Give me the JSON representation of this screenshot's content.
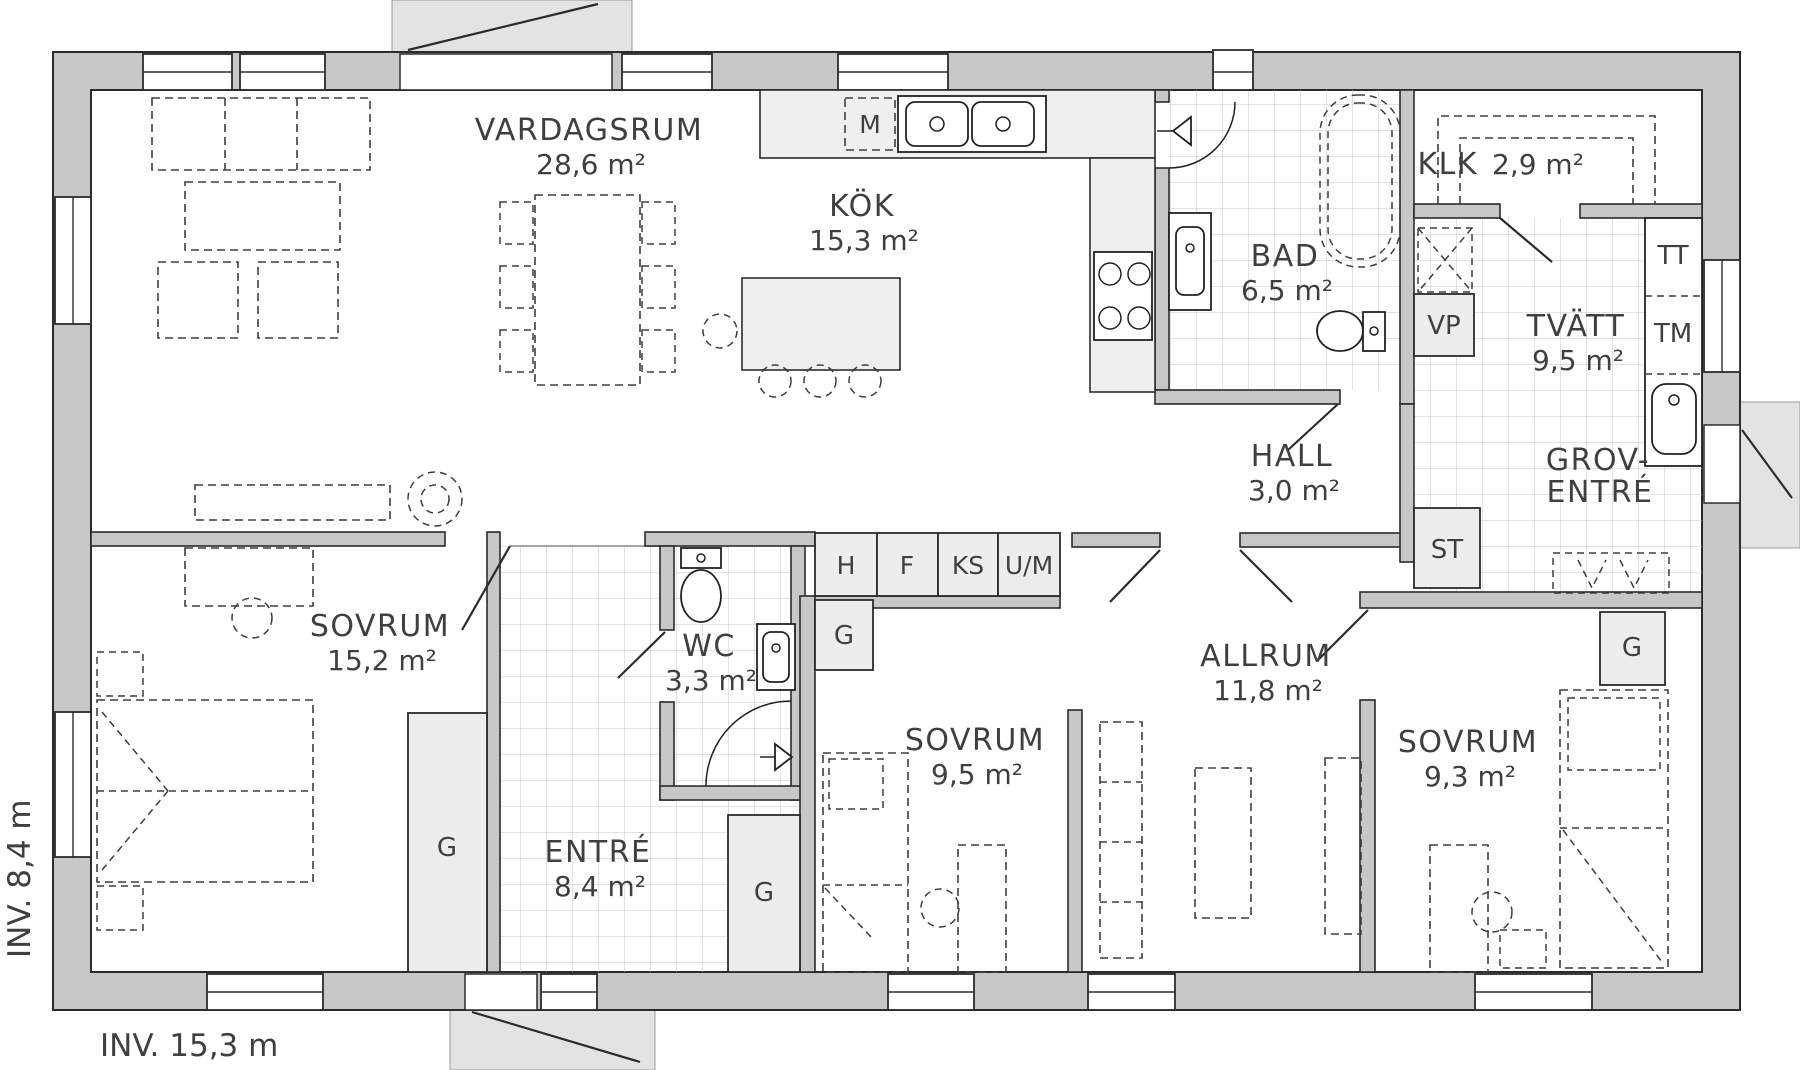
{
  "plan": {
    "rooms": {
      "vardagsrum": {
        "name": "VARDAGSRUM",
        "area": "28,6 m²"
      },
      "kok": {
        "name": "KÖK",
        "area": "15,3 m²"
      },
      "bad": {
        "name": "BAD",
        "area": "6,5 m²"
      },
      "klk": {
        "name": "KLK",
        "area": "2,9 m²"
      },
      "tvatt": {
        "name": "TVÄTT",
        "area": "9,5 m²"
      },
      "hall": {
        "name": "HALL",
        "area": "3,0 m²"
      },
      "groventre": {
        "line1": "GROV-",
        "line2": "ENTRÉ"
      },
      "sovrum1": {
        "name": "SOVRUM",
        "area": "15,2 m²"
      },
      "wc": {
        "name": "WC",
        "area": "3,3 m²"
      },
      "entre": {
        "name": "ENTRÉ",
        "area": "8,4 m²"
      },
      "sovrum2": {
        "name": "SOVRUM",
        "area": "9,5 m²"
      },
      "allrum": {
        "name": "ALLRUM",
        "area": "11,8 m²"
      },
      "sovrum3": {
        "name": "SOVRUM",
        "area": "9,3 m²"
      }
    },
    "units": {
      "dishwasher": "M",
      "h": "H",
      "f": "F",
      "ks": "KS",
      "um": "U/M",
      "g": "G",
      "vp": "VP",
      "st": "ST",
      "tt": "TT",
      "tm": "TM"
    },
    "dimensions": {
      "width": "INV. 15,3 m",
      "height": "INV. 8,4 m"
    },
    "colors": {
      "wall": "#c7c7c7",
      "outline": "#2b2b2b",
      "unit_fill": "#ededed",
      "porch": "#e3e3e3",
      "tile_line": "#c6c6c6",
      "text": "#3f3f3f"
    }
  }
}
